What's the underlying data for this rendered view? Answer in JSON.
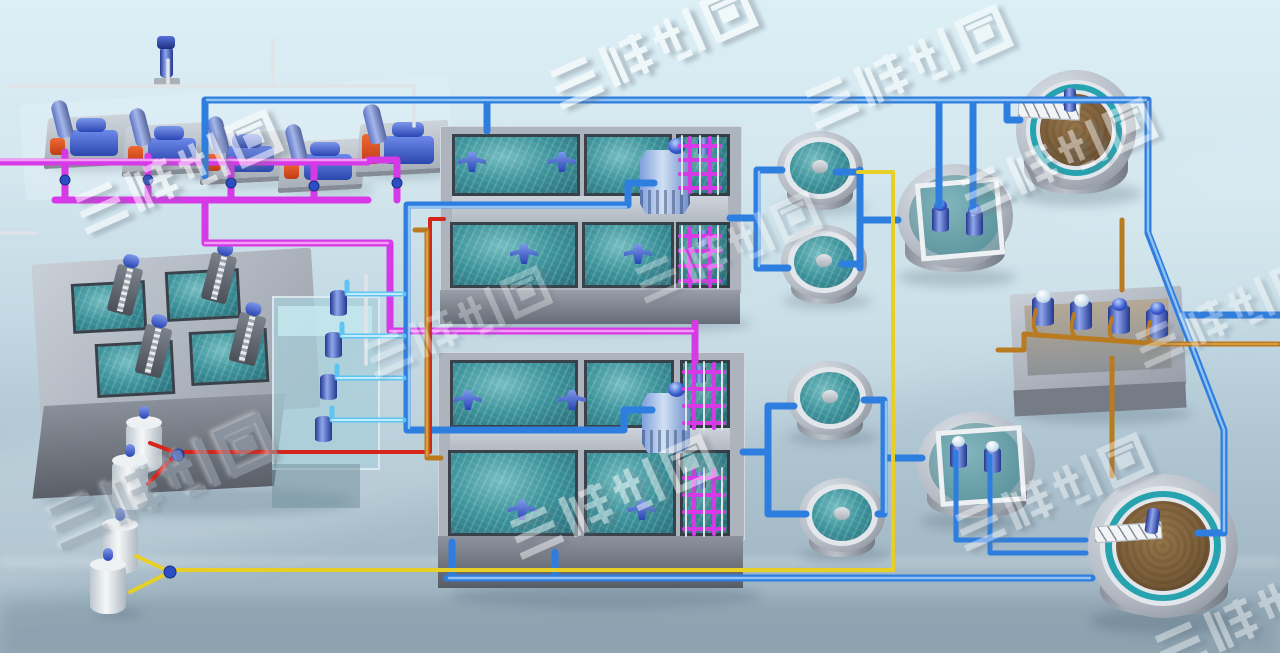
{
  "watermark": {
    "text": "三维制图"
  },
  "colors": {
    "bgTop": "#dceff5",
    "bgBottom": "#9cb0be",
    "pipeMagenta": "#d63ae6",
    "pipeMagentaLight": "#f7a6fb",
    "pipeBlue": "#2e7ee0",
    "pipeBlueLight": "#9ccaf6",
    "pipeCyan": "#5ec5f2",
    "pipeCyanLight": "#d6f3fd",
    "pipeRed": "#d6251a",
    "pipeYellow": "#e8cf25",
    "pipeOrange": "#b97a20",
    "pipeOrangeLight": "#e8ab52",
    "pipeSilver": "#dfe4e9",
    "waterTeal": "#3d949c",
    "sludgeBrown": "#7c5e3a",
    "equipBlueDark": "#23388f",
    "equipBlueLight": "#8fa6ec"
  },
  "equipment": {
    "blower_station": {
      "blowers": 5,
      "standby_pump": 1
    },
    "inlet_screens": {
      "channels": 4,
      "screen_machines": 4
    },
    "lift_sump": {
      "submersible_pumps": 4
    },
    "aeration_basins": {
      "blocks": 2,
      "cells_per_block": 4,
      "mixers": 8,
      "diffuser_grids": 4,
      "distribution_towers": 2
    },
    "round_tanks": {
      "count": 4
    },
    "round_pump_pits": {
      "count": 2,
      "pumps_each": 2
    },
    "sludge_pump_pit": {
      "pumps": 4
    },
    "clarifiers": {
      "count": 2,
      "scraper_bridges": 2
    },
    "dosing_stations": {
      "tanks": 4
    }
  }
}
